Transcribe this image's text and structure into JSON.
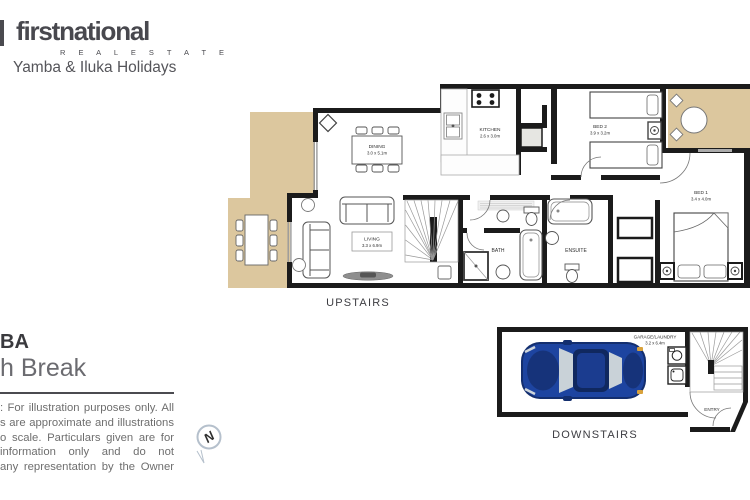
{
  "header": {
    "brand": "firstnational",
    "brand_sub": "R E A L   E S T A T E",
    "tagline": "Yamba & Iluka Holidays"
  },
  "property": {
    "title_fragment": "BA",
    "subtitle_fragment": "h Break"
  },
  "disclaimer": {
    "lines": [
      ": For illustration purposes only. All",
      "s are approximate and illustrations",
      "o scale. Particulars given are for",
      "information only and do not",
      "any representation by the Owner"
    ]
  },
  "compass": {
    "letter": "N"
  },
  "floorplan": {
    "upstairs_label": "UPSTAIRS",
    "downstairs_label": "DOWNSTAIRS",
    "rooms": {
      "dining": {
        "name": "DINING",
        "dims": "3.0 x 5.1m"
      },
      "kitchen": {
        "name": "KITCHEN",
        "dims": "2.6 x 3.0m"
      },
      "living": {
        "name": "LIVING",
        "dims": "3.3 x 6.9m"
      },
      "bath": {
        "name": "BATH"
      },
      "ensuite": {
        "name": "ENSUITE"
      },
      "bed2": {
        "name": "BED 2",
        "dims": "3.9 x 3.2m"
      },
      "bed1": {
        "name": "BED 1",
        "dims": "3.4 x 4.0m"
      },
      "garage": {
        "name": "GARAGE/LAUNDRY",
        "dims": "3.2 x 6.4m"
      },
      "entry": {
        "name": "ENTRY"
      }
    },
    "colors": {
      "wall": "#1b1b1b",
      "deck": "#dcc79e",
      "car_body": "#1d44a0",
      "car_dark": "#132e6e",
      "glass": "#c9d2d8"
    }
  }
}
